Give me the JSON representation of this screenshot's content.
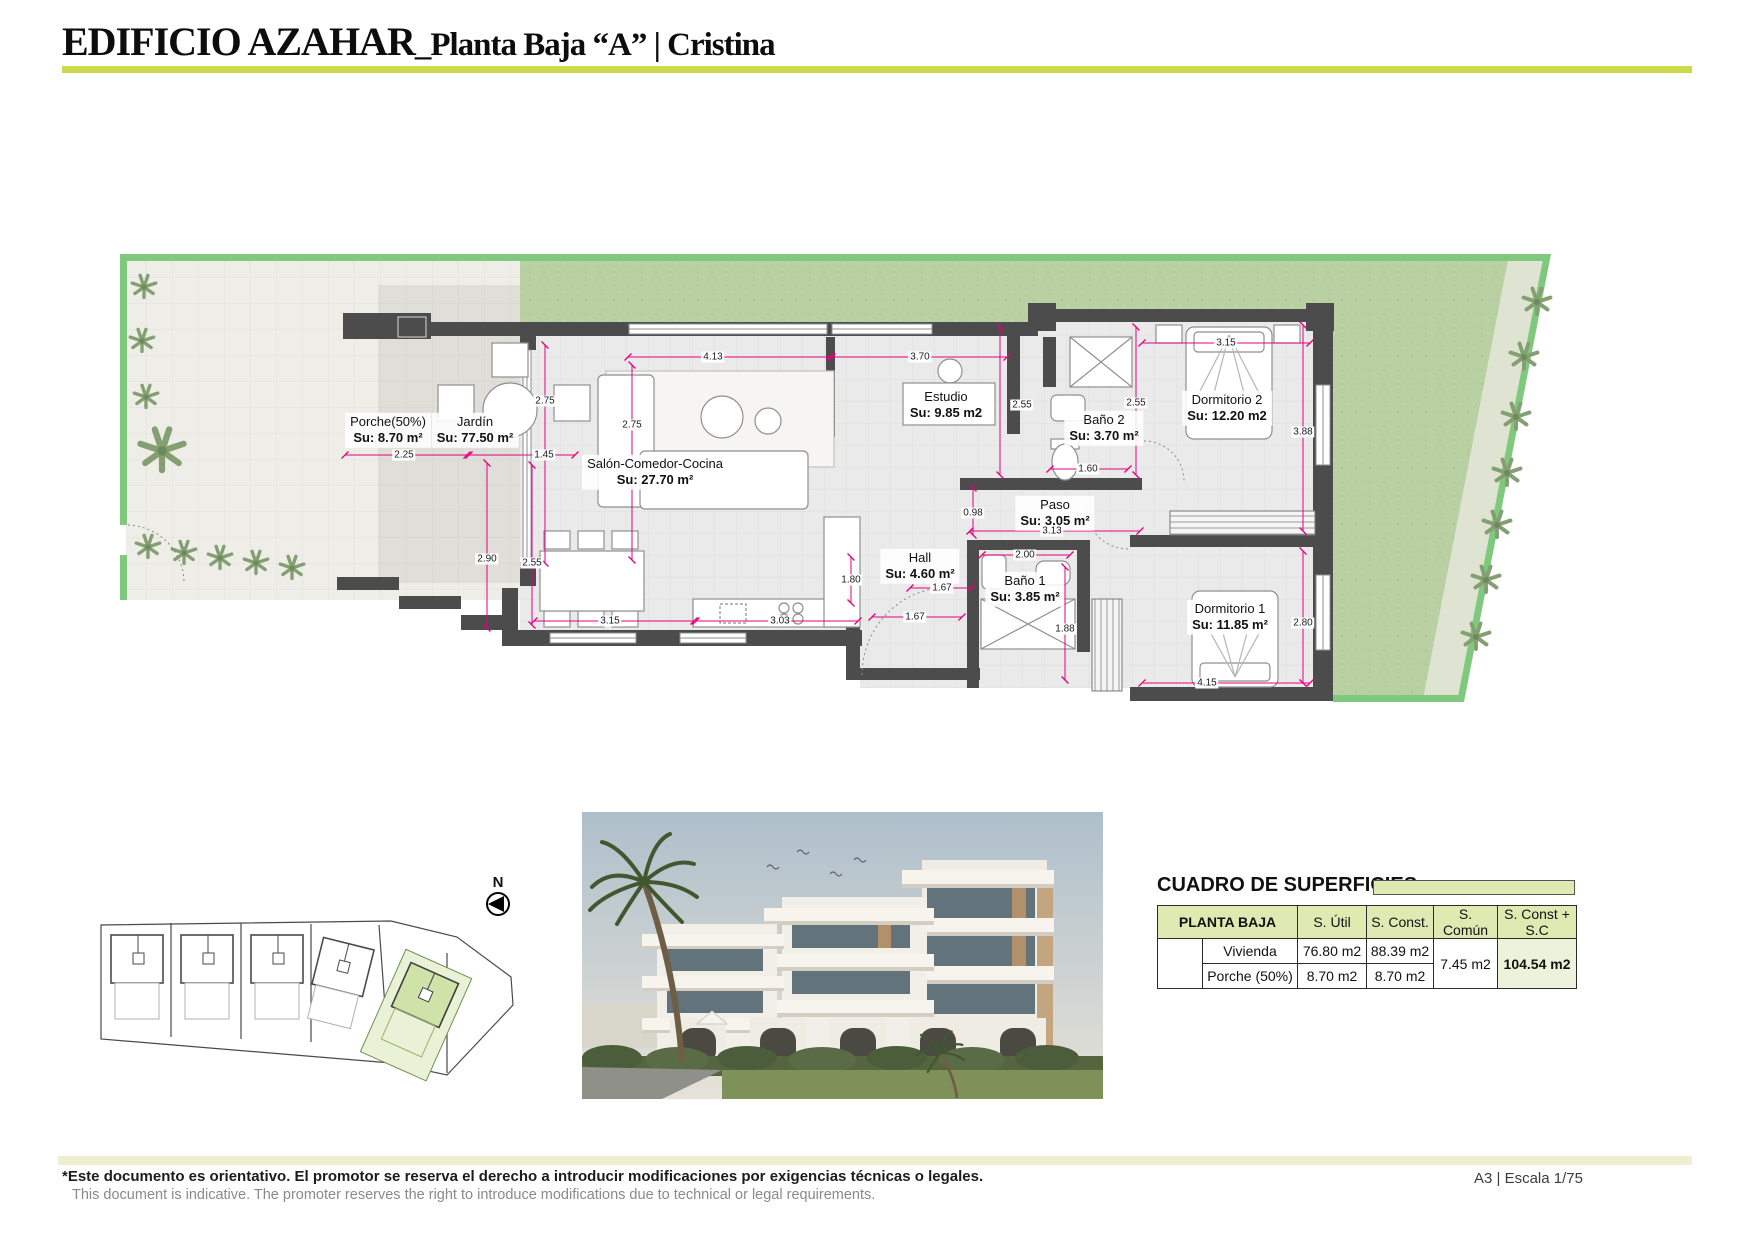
{
  "header": {
    "title_part1": "EDIFICIO AZAHAR",
    "title_part2": "_Planta Baja “A” | Cristina"
  },
  "plan": {
    "north_label": "N",
    "rooms": [
      {
        "name": "Jardín",
        "area": "Su: 77.50 m²"
      },
      {
        "name": "Porche(50%)",
        "area": "Su: 8.70 m²"
      },
      {
        "name": "Salón-Comedor-Cocina",
        "area": "Su: 27.70 m²"
      },
      {
        "name": "Estudio",
        "area": "Su: 9.85 m2"
      },
      {
        "name": "Baño 2",
        "area": "Su: 3.70 m²"
      },
      {
        "name": "Dormitorio 2",
        "area": "Su: 12.20 m2"
      },
      {
        "name": "Paso",
        "area": "Su: 3.05 m²"
      },
      {
        "name": "Hall",
        "area": "Su: 4.60 m²"
      },
      {
        "name": "Baño 1",
        "area": "Su: 3.85 m²"
      },
      {
        "name": "Dormitorio 1",
        "area": "Su: 11.85 m²"
      }
    ],
    "dims": [
      "4.13",
      "3.70",
      "2.75",
      "2.75",
      "2.25",
      "1.45",
      "2.90",
      "2.55",
      "3.15",
      "3.03",
      "1.67",
      "1.67",
      "1.80",
      "0.98",
      "2.00",
      "1.88",
      "1.60",
      "2.55",
      "2.55",
      "3.13",
      "3.15",
      "3.88",
      "2.80",
      "4.15"
    ]
  },
  "table": {
    "title": "CUADRO DE SUPERFICIES",
    "header": {
      "col_group": "PLANTA BAJA",
      "cols": [
        "S. Útil",
        "S. Const.",
        "S. Común",
        "S. Const + S.C"
      ]
    },
    "rows": [
      {
        "label": "Vivienda",
        "util": "76.80 m2",
        "construida": "88.39 m2"
      },
      {
        "label": "Porche (50%)",
        "util": "8.70 m2",
        "construida": "8.70 m2"
      }
    ],
    "comun": "7.45 m2",
    "total": "104.54 m2"
  },
  "footer": {
    "disclaimer_es": "*Este documento es orientativo. El promotor se reserva el derecho a introducir modificaciones por exigencias técnicas o legales.",
    "disclaimer_en": "This document is indicative. The promoter reserves the right to introduce modifications due to technical or legal requirements.",
    "sheet_info": "A3 | Escala 1/75"
  },
  "colors": {
    "accent_line": "#ccd94b",
    "table_header": "#dfe9b2",
    "plot_border_green": "#7fc97f",
    "lawn_green": "#b9d0a2",
    "dimension_pink": "#e5007e",
    "wall_gray": "#4c4c4c"
  }
}
